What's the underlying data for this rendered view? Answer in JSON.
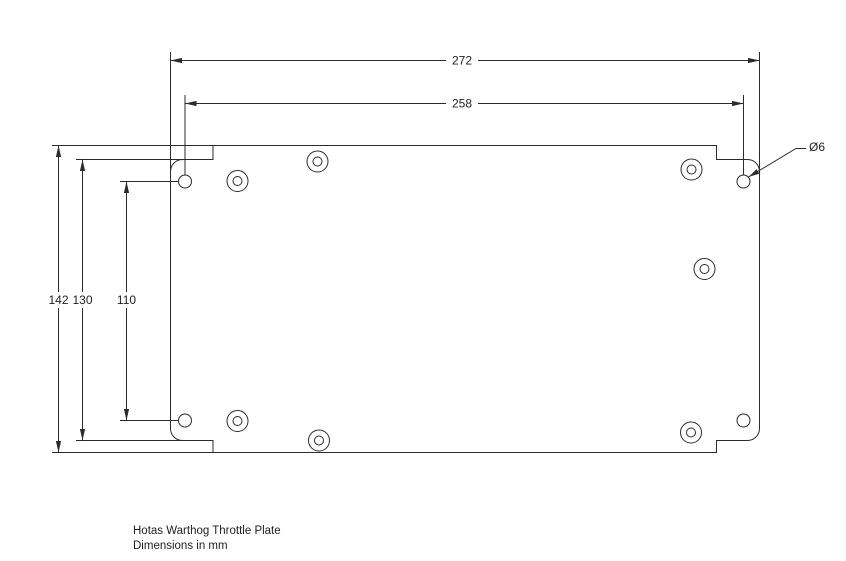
{
  "caption": {
    "line1": "Hotas Warthog Throttle Plate",
    "line2": "Dimensions in mm"
  },
  "dimension_labels": {
    "overall_width": "272",
    "hole_span_width": "258",
    "overall_height": "142",
    "notch_height": "130",
    "hole_span_height": "110",
    "hole_diameter": "Ø6"
  },
  "drawing": {
    "type": "technical-dimension-drawing",
    "part_name": "Hotas Warthog Throttle Plate",
    "units": "mm",
    "measurements_mm": {
      "overall_width": 272,
      "hole_span_width": 258,
      "overall_height": 142,
      "notch_height": 130,
      "hole_span_height": 110,
      "hole_diameter": 6
    },
    "colors": {
      "line": "#2b2b2b",
      "text": "#1f1f1f",
      "background": "#ffffff"
    }
  }
}
